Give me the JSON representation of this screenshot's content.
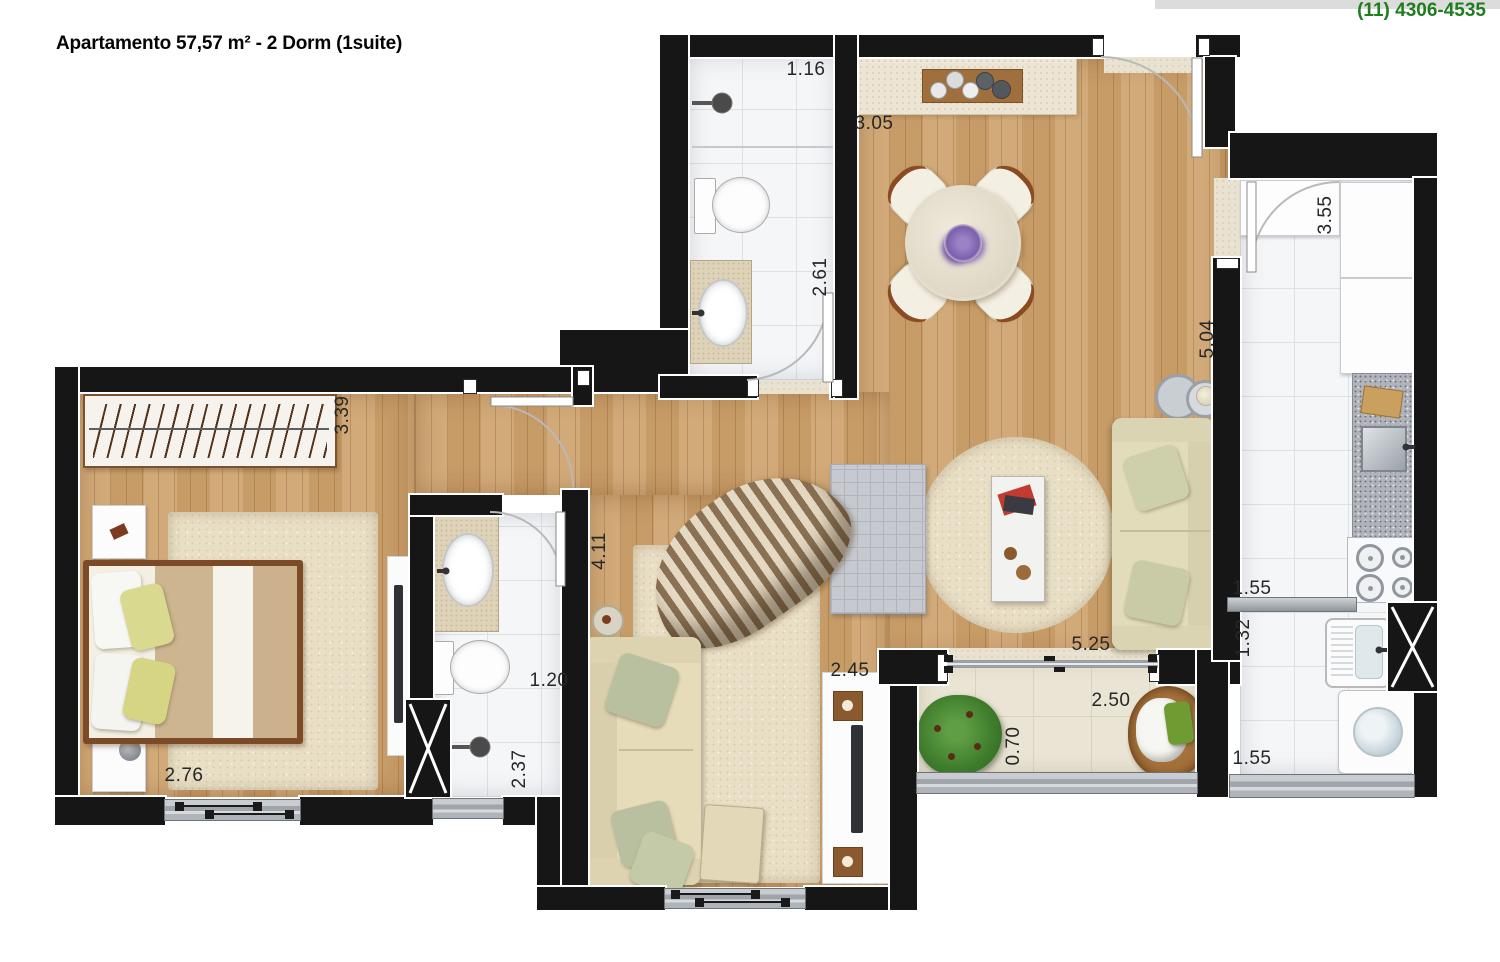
{
  "header": {
    "title": "Apartamento 57,57 m² - 2 Dorm (1suite)",
    "phone": "(11) 4306-4535"
  },
  "plan": {
    "dimension_labels": [
      {
        "text": "1.16",
        "x": 806,
        "y": 70,
        "vertical": false
      },
      {
        "text": "3.05",
        "x": 874,
        "y": 124,
        "vertical": false
      },
      {
        "text": "2.61",
        "x": 821,
        "y": 277,
        "vertical": true
      },
      {
        "text": "3.55",
        "x": 1326,
        "y": 215,
        "vertical": true
      },
      {
        "text": "5.04",
        "x": 1208,
        "y": 339,
        "vertical": true
      },
      {
        "text": "3.39",
        "x": 343,
        "y": 415,
        "vertical": true
      },
      {
        "text": "4.11",
        "x": 600,
        "y": 551,
        "vertical": true
      },
      {
        "text": "1.20",
        "x": 549,
        "y": 681,
        "vertical": false
      },
      {
        "text": "2.37",
        "x": 520,
        "y": 769,
        "vertical": true
      },
      {
        "text": "2.76",
        "x": 184,
        "y": 776,
        "vertical": false
      },
      {
        "text": "2.45",
        "x": 850,
        "y": 671,
        "vertical": false
      },
      {
        "text": "0.70",
        "x": 1014,
        "y": 746,
        "vertical": true
      },
      {
        "text": "2.50",
        "x": 1111,
        "y": 701,
        "vertical": false
      },
      {
        "text": "5.25",
        "x": 1091,
        "y": 645,
        "vertical": false
      },
      {
        "text": "1.55",
        "x": 1252,
        "y": 589,
        "vertical": false
      },
      {
        "text": "1.32",
        "x": 1244,
        "y": 638,
        "vertical": true
      },
      {
        "text": "1.55",
        "x": 1252,
        "y": 759,
        "vertical": false
      }
    ],
    "symbols": [
      "double-bed",
      "wardrobe-hangers",
      "nightstand",
      "tv-rack",
      "area-rug",
      "sofa",
      "sofa-bed",
      "striped-armchair",
      "ottoman",
      "coffee-table",
      "round-dining-table",
      "dining-chair",
      "sideboard",
      "toilet",
      "washbasin-oval",
      "shower-head",
      "vanity-counter",
      "gas-stove",
      "kitchen-square-sink",
      "fridge-cabinet",
      "granite-counter",
      "laundry-tank",
      "washing-machine",
      "potted-plant",
      "wicker-patio-chair",
      "nesting-side-tables",
      "duct-shaft-x",
      "swing-door",
      "sliding-door",
      "window"
    ]
  },
  "colors": {
    "wall": "#161616",
    "wood_floor": "#cfa46f",
    "tile_floor": "#f5f6f8",
    "balcony_floor": "#eae4d4",
    "rug": "#e9dfc6",
    "phone_green": "#1e7d1e",
    "label_text": "#272727"
  }
}
